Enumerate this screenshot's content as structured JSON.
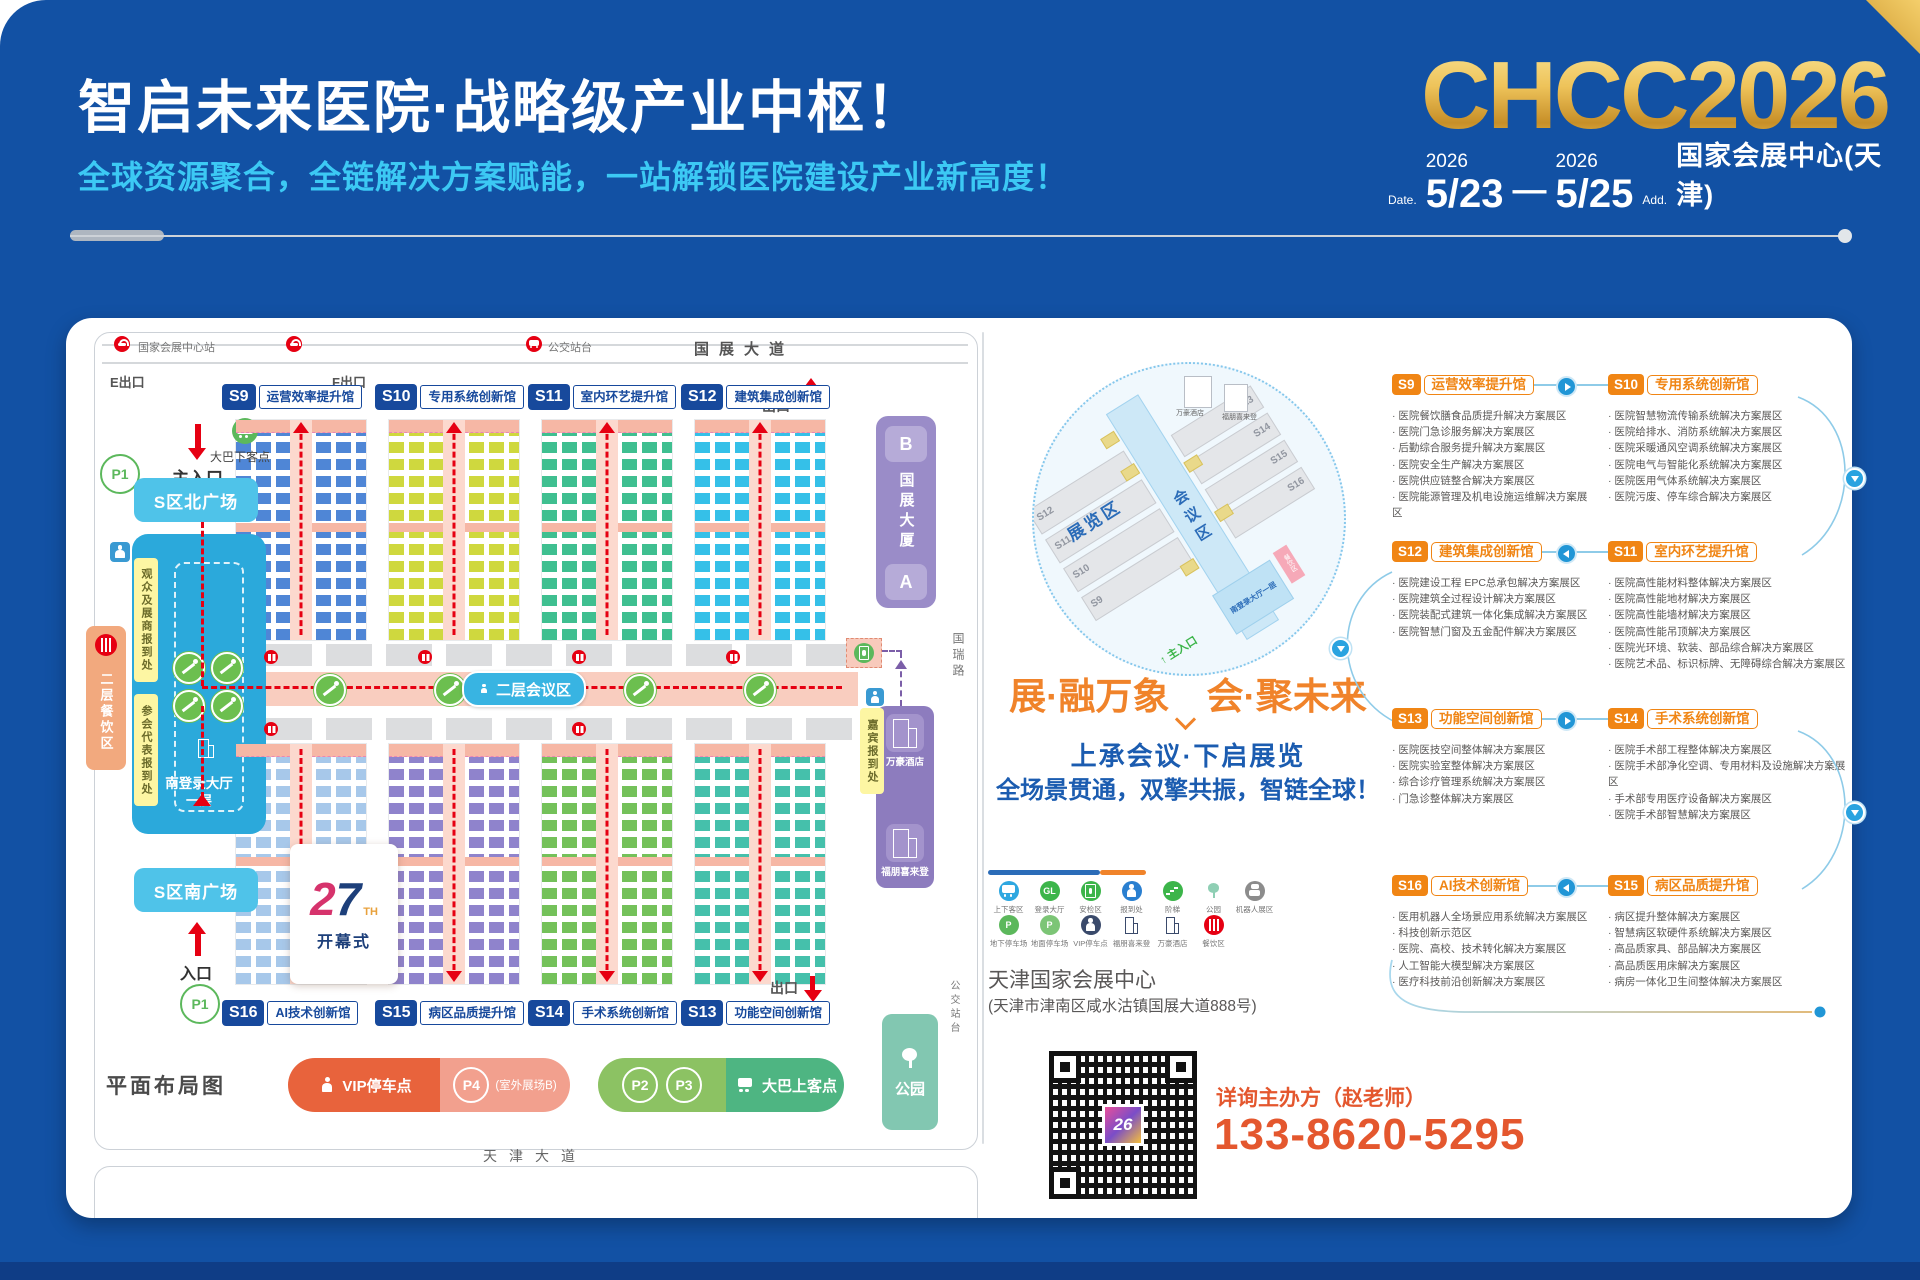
{
  "header": {
    "title": "智启未来医院·战略级产业中枢！",
    "subtitle": "全球资源聚合，全链解决方案赋能，一站解锁医院建设产业新高度！",
    "logo": "CHCC2026",
    "date_label": "Date.",
    "year_a": "2026",
    "day_a": "5/23",
    "dash": "—",
    "year_b": "2026",
    "day_b": "5/25",
    "addr_label": "Add.",
    "venue": "国家会展中心(天津)"
  },
  "map": {
    "top": {
      "station": "国家会展中心站",
      "bus_stop": "公交站台",
      "road": "国展大道",
      "exit_e": "E出口",
      "exit_f": "F出口",
      "exit_top": "出口",
      "exit_bottom": "出口"
    },
    "halls_top": [
      {
        "id": "S9",
        "name": "运营效率提升馆",
        "booth": "#4f86d6"
      },
      {
        "id": "S10",
        "name": "专用系统创新馆",
        "booth": "#cfd83e"
      },
      {
        "id": "S11",
        "name": "室内环艺提升馆",
        "booth": "#3fbf90"
      },
      {
        "id": "S12",
        "name": "建筑集成创新馆",
        "booth": "#35c0e8"
      }
    ],
    "halls_bottom": [
      {
        "id": "S16",
        "name": "AI技术创新馆",
        "booth": "#a7c8ea"
      },
      {
        "id": "S15",
        "name": "病区品质提升馆",
        "booth": "#8f83cc"
      },
      {
        "id": "S14",
        "name": "手术系统创新馆",
        "booth": "#74c15a"
      },
      {
        "id": "S13",
        "name": "功能空间创新馆",
        "booth": "#45c0ab"
      }
    ],
    "left": {
      "p1": "P1",
      "main_entrance": "主入口",
      "bus_drop": "大巴下客点",
      "north_plaza": "S区北广场",
      "reg_visitor": "观众及展商报到处",
      "reg_delegate": "参会代表报到处",
      "dining": "二层餐饮区",
      "lobby": "南登录大厅",
      "floor": "一层",
      "south_plaza": "S区南广场",
      "entrance": "入口",
      "p1b": "P1"
    },
    "center": {
      "conference": "二层会议区",
      "opening_num": "27",
      "opening_th": "TH",
      "opening": "开幕式"
    },
    "right": {
      "b": "B",
      "tower": "国展大厦",
      "a": "A",
      "road": "国瑞路",
      "vip_reg": "嘉宾报到处",
      "hotel_marriott": "万豪酒店",
      "hotel_fourpoints": "福朋喜来登",
      "park": "公园",
      "bus_platform": "公交站台"
    },
    "bottom": {
      "vip_parking": "VIP停车点",
      "p4": "P4",
      "p4_note": "(室外展场B)",
      "p2": "P2",
      "p3": "P3",
      "bus_pickup": "大巴上客点",
      "plan_label": "平面布局图",
      "road": "天津大道"
    }
  },
  "minimap": {
    "expo": "展览区",
    "conf": "会议区",
    "halls_left": [
      "S12",
      "S11",
      "S10",
      "S9"
    ],
    "halls_right": [
      "S13",
      "S14",
      "S15",
      "S16"
    ],
    "lobby": "南登录大厅一层",
    "dining": "餐饮区",
    "hotel1": "万豪酒店",
    "hotel2": "福朋喜来登",
    "entrance": "主入口"
  },
  "middle": {
    "slogan": "展·融万象　会·聚未来",
    "sub1": "上承会议·下启展览",
    "sub2": "全场景贯通，双擎共振，智链全球！",
    "venue_name": "天津国家会展中心",
    "venue_addr": "(天津市津南区咸水沽镇国展大道888号)",
    "contact_label": "详询主办方（赵老师）",
    "phone": "133-8620-5295",
    "qr_logo": "26"
  },
  "legend": {
    "row1": [
      {
        "label": "上下客区",
        "kind": "bus",
        "icon": "bus-icon",
        "color": "#2ea7e0"
      },
      {
        "label": "登录大厅",
        "kind": "text",
        "glyph": "GL",
        "icon": "login-hall-icon",
        "color": "#3cb54a"
      },
      {
        "label": "安检区",
        "kind": "gate",
        "icon": "security-gate-icon",
        "color": "#3cb54a"
      },
      {
        "label": "报到处",
        "kind": "person",
        "icon": "registration-icon",
        "color": "#2a7fd0"
      },
      {
        "label": "阶梯",
        "kind": "stairs",
        "icon": "stairs-icon",
        "color": "#3cb54a"
      },
      {
        "label": "公园",
        "kind": "tree",
        "icon": "park-icon",
        "color": "transparent",
        "fg": "#8fcfb4"
      },
      {
        "label": "机器人展区",
        "kind": "robot",
        "icon": "robot-icon",
        "color": "#8c8c8c"
      }
    ],
    "row2": [
      {
        "label": "地下停车场",
        "kind": "text",
        "glyph": "P",
        "icon": "underground-parking-icon",
        "color": "#5cb85c"
      },
      {
        "label": "地面停车场",
        "kind": "text",
        "glyph": "P",
        "icon": "ground-parking-icon",
        "color": "#7cc576"
      },
      {
        "label": "VIP停车点",
        "kind": "person",
        "icon": "vip-parking-icon",
        "color": "#3a4a6b"
      },
      {
        "label": "福朋喜来登",
        "kind": "building",
        "icon": "fourpoints-hotel-icon",
        "color": "transparent",
        "fg": "#3a4a6b"
      },
      {
        "label": "万豪酒店",
        "kind": "building",
        "icon": "marriott-hotel-icon",
        "color": "transparent",
        "fg": "#3a4a6b"
      },
      {
        "label": "餐饮区",
        "kind": "fork",
        "icon": "dining-icon",
        "color": "#e60012"
      }
    ]
  },
  "listings": {
    "rows": [
      {
        "arrow": "right",
        "left": {
          "id": "S9",
          "name": "运营效率提升馆",
          "items": [
            "医院餐饮膳食品质提升解决方案展区",
            "医院门急诊服务解决方案展区",
            "后勤综合服务提升解决方案展区",
            "医院安全生产解决方案展区",
            "医院供应链整合解决方案展区",
            "医院能源管理及机电设施运维解决方案展区"
          ]
        },
        "right": {
          "id": "S10",
          "name": "专用系统创新馆",
          "items": [
            "医院智慧物流传输系统解决方案展区",
            "医院给排水、消防系统解决方案展区",
            "医院采暖通风空调系统解决方案展区",
            "医院电气与智能化系统解决方案展区",
            "医院医用气体系统解决方案展区",
            "医院污废、停车综合解决方案展区"
          ]
        }
      },
      {
        "arrow": "left",
        "left": {
          "id": "S12",
          "name": "建筑集成创新馆",
          "items": [
            "医院建设工程 EPC总承包解决方案展区",
            "医院建筑全过程设计解决方案展区",
            "医院装配式建筑一体化集成解决方案展区",
            "医院智慧门窗及五金配件解决方案展区"
          ]
        },
        "right": {
          "id": "S11",
          "name": "室内环艺提升馆",
          "items": [
            "医院高性能材料整体解决方案展区",
            "医院高性能地材解决方案展区",
            "医院高性能墙材解决方案展区",
            "医院高性能吊顶解决方案展区",
            "医院光环境、软装、部品综合解决方案展区",
            "医院艺术品、标识标牌、无障碍综合解决方案展区"
          ]
        }
      },
      {
        "arrow": "right",
        "left": {
          "id": "S13",
          "name": "功能空间创新馆",
          "items": [
            "医院医技空间整体解决方案展区",
            "医院实验室整体解决方案展区",
            "综合诊疗管理系统解决方案展区",
            "门急诊整体解决方案展区"
          ]
        },
        "right": {
          "id": "S14",
          "name": "手术系统创新馆",
          "items": [
            "医院手术部工程整体解决方案展区",
            "医院手术部净化空调、专用材料及设施解决方案展区",
            "手术部专用医疗设备解决方案展区",
            "医院手术部智慧解决方案展区"
          ]
        }
      },
      {
        "arrow": "left",
        "left": {
          "id": "S16",
          "name": "AI技术创新馆",
          "items": [
            "医用机器人全场景应用系统解决方案展区",
            "科技创新示范区",
            "医院、高校、技术转化解决方案展区",
            "人工智能大模型解决方案展区",
            "医疗科技前沿创新解决方案展区"
          ]
        },
        "right": {
          "id": "S15",
          "name": "病区品质提升馆",
          "items": [
            "病区提升整体解决方案展区",
            "智慧病区软硬件系统解决方案展区",
            "高品质家具、部品解决方案展区",
            "高品质医用床解决方案展区",
            "病房一体化卫生间整体解决方案展区"
          ]
        }
      }
    ]
  }
}
